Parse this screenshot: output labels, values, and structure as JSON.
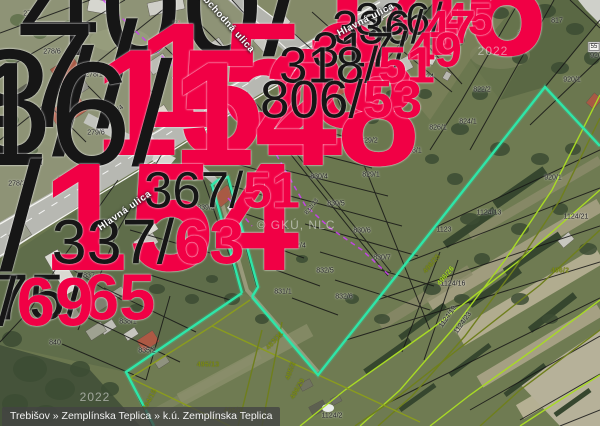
{
  "statusbar": {
    "breadcrumb": "Trebišov » Zemplínska Teplica » k.ú. Zemplínska Teplica"
  },
  "colors": {
    "selected_parcel": "#2ee6a8",
    "parcel_boundary": "#161616",
    "utility_line": "#cb3ff2",
    "field_boundary_olive": "#6f7f1c",
    "field_boundary_bright": "#a8da25",
    "building_number_red": "#f10045",
    "road_fill": "#b7b8b2"
  },
  "map": {
    "streets": [
      {
        "t": "Obchodná ulica",
        "x": 226,
        "y": 22,
        "r": 48
      },
      {
        "t": "Hlavná ulica",
        "x": 366,
        "y": 20,
        "r": -27
      },
      {
        "t": "Hlavná ulica",
        "x": 125,
        "y": 211,
        "r": -35
      }
    ],
    "watermarks": [
      {
        "t": "2022",
        "x": 493,
        "y": 51
      },
      {
        "t": "2022",
        "x": 95,
        "y": 397
      },
      {
        "t": "© GKÚ, NLC",
        "x": 296,
        "y": 225
      }
    ],
    "parcel_labels": [
      {
        "t": "278/5",
        "x": 32,
        "y": 14
      },
      {
        "t": "278/6",
        "x": 52,
        "y": 52
      },
      {
        "t": "278/1",
        "x": 94,
        "y": 75
      },
      {
        "t": "80/6",
        "x": 170,
        "y": 40
      },
      {
        "t": "80/8",
        "x": 198,
        "y": 75
      },
      {
        "t": "80/9",
        "x": 233,
        "y": 97
      },
      {
        "t": "822/1",
        "x": 429,
        "y": 32
      },
      {
        "t": "821",
        "x": 484,
        "y": 41
      },
      {
        "t": "820",
        "x": 524,
        "y": 34
      },
      {
        "t": "817",
        "x": 557,
        "y": 21
      },
      {
        "t": "825/1",
        "x": 383,
        "y": 70
      },
      {
        "t": "824",
        "x": 428,
        "y": 77
      },
      {
        "t": "822/2",
        "x": 482,
        "y": 90
      },
      {
        "t": "824/1",
        "x": 468,
        "y": 122
      },
      {
        "t": "826/1",
        "x": 438,
        "y": 128
      },
      {
        "t": "920/1",
        "x": 572,
        "y": 80
      },
      {
        "t": "920/1",
        "x": 553,
        "y": 178
      },
      {
        "t": "829/2",
        "x": 369,
        "y": 141
      },
      {
        "t": "828/1",
        "x": 413,
        "y": 151
      },
      {
        "t": "829/1",
        "x": 371,
        "y": 175
      },
      {
        "t": "830/2",
        "x": 274,
        "y": 124
      },
      {
        "t": "830/3",
        "x": 301,
        "y": 153
      },
      {
        "t": "830/4",
        "x": 319,
        "y": 177
      },
      {
        "t": "830/5",
        "x": 336,
        "y": 204
      },
      {
        "t": "830/6",
        "x": 362,
        "y": 231
      },
      {
        "t": "830/7",
        "x": 382,
        "y": 258
      },
      {
        "t": "832/1",
        "x": 236,
        "y": 161
      },
      {
        "t": "832/2",
        "x": 257,
        "y": 187
      },
      {
        "t": "832/3",
        "x": 275,
        "y": 216
      },
      {
        "t": "832/4",
        "x": 297,
        "y": 246
      },
      {
        "t": "832/23",
        "x": 312,
        "y": 207,
        "r": -52,
        "s": 6
      },
      {
        "t": "832/5",
        "x": 325,
        "y": 271
      },
      {
        "t": "831/1",
        "x": 283,
        "y": 292
      },
      {
        "t": "832/6",
        "x": 344,
        "y": 297
      },
      {
        "t": "839/2",
        "x": 206,
        "y": 208
      },
      {
        "t": "835/1",
        "x": 176,
        "y": 268
      },
      {
        "t": "837",
        "x": 89,
        "y": 276
      },
      {
        "t": "278/3",
        "x": 17,
        "y": 184
      },
      {
        "t": "279/1",
        "x": 66,
        "y": 180
      },
      {
        "t": "279/6",
        "x": 96,
        "y": 133
      },
      {
        "t": "278/4",
        "x": 116,
        "y": 112,
        "r": -38
      },
      {
        "t": "838/1",
        "x": 128,
        "y": 322
      },
      {
        "t": "835/2",
        "x": 147,
        "y": 351
      },
      {
        "t": "840",
        "x": 55,
        "y": 343
      },
      {
        "t": "1123",
        "x": 444,
        "y": 230
      },
      {
        "t": "1124/13",
        "x": 489,
        "y": 213
      },
      {
        "t": "1124/21",
        "x": 576,
        "y": 217
      },
      {
        "t": "1124/16",
        "x": 453,
        "y": 284
      },
      {
        "t": "1124/19",
        "x": 448,
        "y": 317,
        "r": -55
      },
      {
        "t": "1124/23",
        "x": 463,
        "y": 323,
        "r": -55
      },
      {
        "t": "1124/2",
        "x": 332,
        "y": 416
      },
      {
        "t": "920",
        "x": 596,
        "y": 56
      }
    ],
    "building_labels": [
      {
        "p": "400/",
        "s": "146",
        "x": 283,
        "y": 5
      },
      {
        "p": "171/",
        "s": "3",
        "x": 176,
        "y": 22
      },
      {
        "p": "370/",
        "s": "1",
        "x": 223,
        "y": 60
      },
      {
        "p": "517/",
        "s": "150",
        "x": 117,
        "y": 75
      },
      {
        "p": "518/",
        "s": "152",
        "x": 73,
        "y": 103
      },
      {
        "p": "516/",
        "s": "148",
        "x": 152,
        "y": 115
      },
      {
        "p": "336/",
        "s": "45",
        "x": 424,
        "y": 19
      },
      {
        "p": "336/",
        "s": "47",
        "x": 404,
        "y": 27
      },
      {
        "p": "317/",
        "s": "49",
        "x": 387,
        "y": 51
      },
      {
        "p": "318/",
        "s": "51",
        "x": 357,
        "y": 65
      },
      {
        "p": "806/",
        "s": "53",
        "x": 341,
        "y": 100
      },
      {
        "p": "320/",
        "s": "154",
        "x": 21,
        "y": 217
      },
      {
        "p": "337/",
        "s": "63",
        "x": 148,
        "y": 243
      },
      {
        "p": "367/",
        "s": "51",
        "x": 222,
        "y": 190
      },
      {
        "p": "75/",
        "s": "65",
        "x": 74,
        "y": 297
      },
      {
        "p": "76/",
        "s": "69",
        "x": 7,
        "y": 302
      }
    ],
    "field_labels": [
      {
        "t": "496/25",
        "x": 432,
        "y": 264,
        "r": -50,
        "c": "olive"
      },
      {
        "t": "496/26",
        "x": 446,
        "y": 276,
        "r": -50,
        "c": "bright"
      },
      {
        "t": "496/2",
        "x": 560,
        "y": 271,
        "c": "olive"
      },
      {
        "t": "495/13",
        "x": 208,
        "y": 365,
        "c": "olive"
      },
      {
        "t": "494/15",
        "x": 150,
        "y": 400,
        "r": -62,
        "c": "olive"
      },
      {
        "t": "485/3",
        "x": 233,
        "y": 411,
        "c": "olive"
      },
      {
        "t": "483/11",
        "x": 275,
        "y": 341,
        "r": -48,
        "c": "olive"
      },
      {
        "t": "485/2",
        "x": 291,
        "y": 371,
        "r": -70,
        "c": "olive"
      },
      {
        "t": "496/29",
        "x": 298,
        "y": 389,
        "r": -60,
        "c": "olive"
      }
    ],
    "chips": [
      {
        "t": "55",
        "x": 594,
        "y": 47
      }
    ]
  }
}
